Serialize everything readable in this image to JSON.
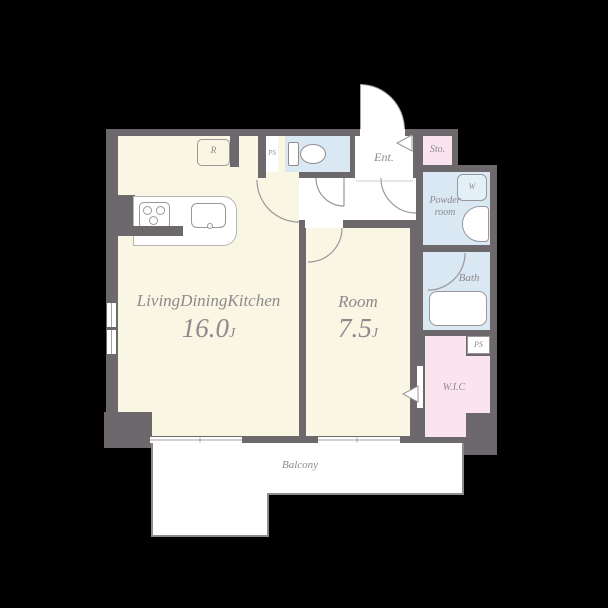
{
  "plan_title": "1LDK apartment floor plan",
  "colors": {
    "background": "#000000",
    "wall": "#6c686c",
    "floor_main": "#f9f6e4",
    "floor_wet": "#d9e8f3",
    "floor_closet": "#fbe4ed",
    "balcony_white": "#ffffff",
    "line": "#9a969a",
    "label": "#8d898d"
  },
  "rooms": {
    "ldk": {
      "label": "LivingDiningKitchen",
      "size": "16.0",
      "unit": "J"
    },
    "bedroom": {
      "label": "Room",
      "size": "7.5",
      "unit": "J"
    },
    "balcony": {
      "label": "Balcony"
    },
    "entrance": {
      "label": "Ent."
    },
    "storage": {
      "label": "Sto."
    },
    "powder": {
      "label_line1": "Powder",
      "label_line2": "room"
    },
    "bath": {
      "label": "Bath"
    },
    "wic": {
      "label": "W.I.C"
    },
    "ps_top": {
      "label": "PS"
    },
    "ps_bottom": {
      "label": "PS"
    },
    "washer": {
      "label": "W"
    },
    "fridge": {
      "label": "R"
    }
  }
}
